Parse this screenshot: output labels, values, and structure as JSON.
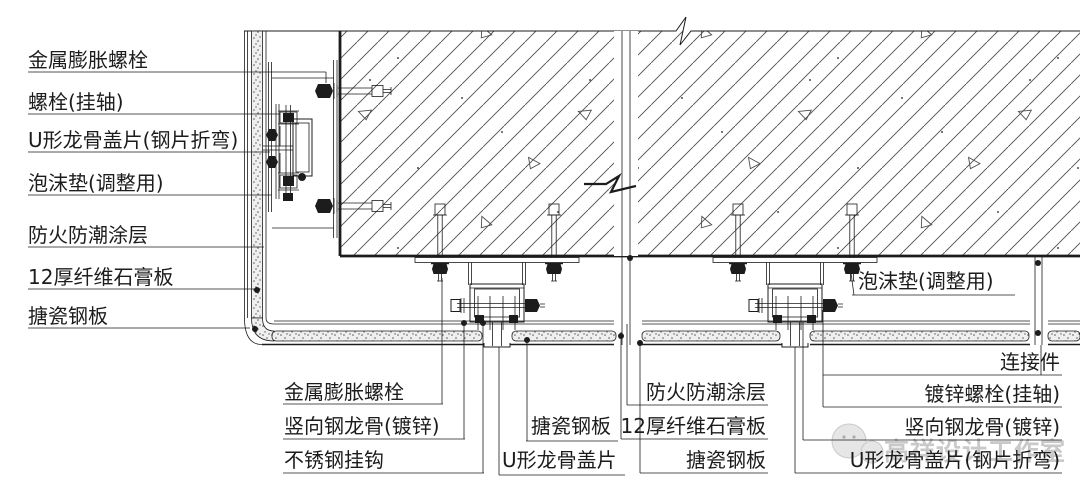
{
  "callouts": {
    "left": [
      "金属膨胀螺栓",
      "螺栓(挂轴)",
      "U形龙骨盖片(钢片折弯)",
      "泡沫垫(调整用)",
      "防火防潮涂层",
      "12厚纤维石膏板",
      "搪瓷钢板"
    ],
    "bottom_left": [
      "金属膨胀螺栓",
      "竖向钢龙骨(镀锌)",
      "不锈钢挂钩"
    ],
    "bottom_mid": [
      "搪瓷钢板",
      "U形龙骨盖片"
    ],
    "bottom_center": [
      "防火防潮涂层",
      "12厚纤维石膏板",
      "搪瓷钢板"
    ],
    "bottom_right": [
      "连接件",
      "镀锌螺栓(挂轴)",
      "竖向钢龙骨(镀锌)",
      "U形龙骨盖片(钢片折弯)"
    ],
    "right": "泡沫垫(调整用)"
  },
  "watermark": {
    "text": "高祥设计工作室"
  },
  "colors": {
    "line": "#1c1c1c",
    "hatch": "#4d4d4d",
    "stipple_dot": "#5a5a5a",
    "band_bg": "#efefef",
    "watermark": "#c9c9c9"
  }
}
